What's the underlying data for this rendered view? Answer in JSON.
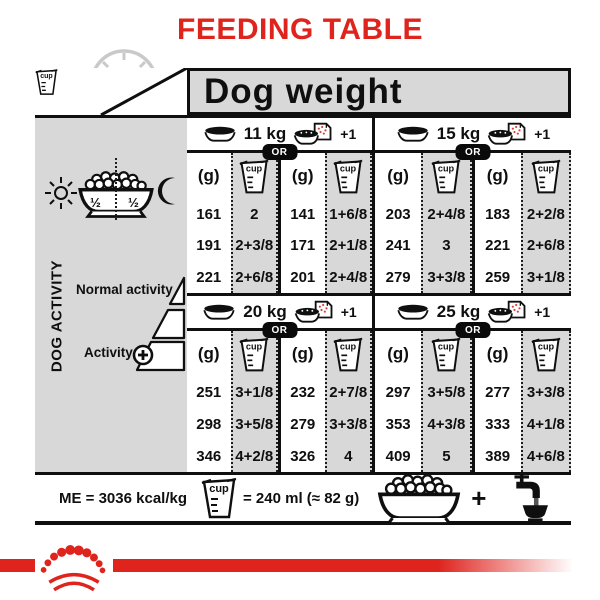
{
  "title": "FEEDING TABLE",
  "colors": {
    "red": "#df241e",
    "table_gray": "#d8d8d8",
    "ink": "#0f0f0f",
    "clock_gray": "#c9c9c9"
  },
  "header": {
    "clock_label": "24H",
    "dog_weight": "Dog weight"
  },
  "labels": {
    "g": "(g)",
    "cup": "cup",
    "or": "OR",
    "plus_one": "+1",
    "half_left": "½",
    "half_right": "½",
    "plus": "+"
  },
  "sidebar": {
    "axis": "DOG ACTIVITY",
    "normal": "Normal activity",
    "active": "Activity"
  },
  "sections": [
    {
      "weight": "11 kg",
      "rows": [
        [
          "161",
          "2",
          "141",
          "1+6/8"
        ],
        [
          "191",
          "2+3/8",
          "171",
          "2+1/8"
        ],
        [
          "221",
          "2+6/8",
          "201",
          "2+4/8"
        ]
      ]
    },
    {
      "weight": "15 kg",
      "rows": [
        [
          "203",
          "2+4/8",
          "183",
          "2+2/8"
        ],
        [
          "241",
          "3",
          "221",
          "2+6/8"
        ],
        [
          "279",
          "3+3/8",
          "259",
          "3+1/8"
        ]
      ]
    },
    {
      "weight": "20 kg",
      "rows": [
        [
          "251",
          "3+1/8",
          "232",
          "2+7/8"
        ],
        [
          "298",
          "3+5/8",
          "279",
          "3+3/8"
        ],
        [
          "346",
          "4+2/8",
          "326",
          "4"
        ]
      ]
    },
    {
      "weight": "25 kg",
      "rows": [
        [
          "297",
          "3+5/8",
          "277",
          "3+3/8"
        ],
        [
          "353",
          "4+3/8",
          "333",
          "4+1/8"
        ],
        [
          "409",
          "5",
          "389",
          "4+6/8"
        ]
      ]
    }
  ],
  "footer": {
    "me": "ME = 3036 kcal/kg",
    "cup_equiv": "= 240 ml (≈ 82 g)"
  },
  "icons": {
    "clock-icon": "24h dial behind bowl",
    "kibble-bowl-icon": "bowl filled with kibble",
    "measuring-cup-icon": "graduated cup labelled cup",
    "empty-bowl-icon": "empty feeding bowl",
    "bowl-pouch-icon": "bowl with wet-food pouch",
    "sun-icon": "day symbol",
    "moon-icon": "night symbol",
    "activity-triangle-icon": "three-step activity ramp",
    "plus-circle-icon": "increase activity",
    "faucet-icon": "tap pouring water into bowl",
    "crown-paw-logo": "red crown of paw dots"
  }
}
